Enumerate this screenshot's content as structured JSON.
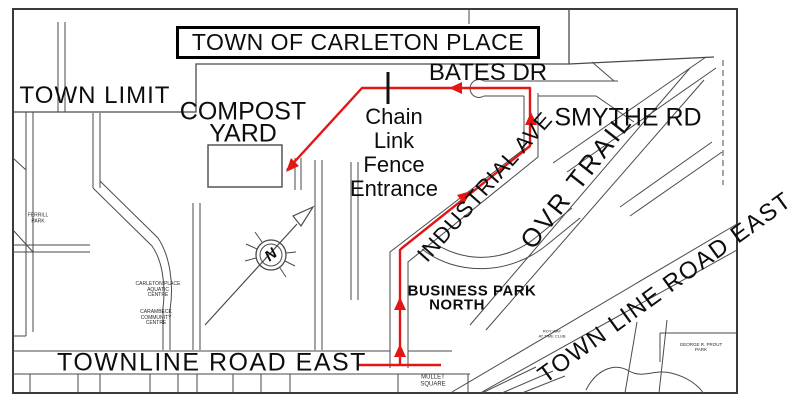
{
  "title": {
    "text": "TOWN OF CARLETON PLACE"
  },
  "areas": {
    "town_limit": "TOWN LIMIT",
    "compost_1": "COMPOST",
    "compost_2": "YARD",
    "business_1": "BUSINESS PARK",
    "business_2": "NORTH"
  },
  "roads": {
    "bates": "BATES DR",
    "smythe": "SMYTHE RD",
    "industrial": "INDUSTRIAL AVE",
    "ovr": "OVR TRAIL",
    "townline_diagonal": "TOWN LINE ROAD EAST",
    "townline_bottom": "TOWNLINE ROAD EAST"
  },
  "route": {
    "entrance_1": "Chain",
    "entrance_2": "Link",
    "entrance_3": "Fence",
    "entrance_4": "Entrance",
    "color": "#e31616"
  },
  "places": {
    "ferrill_1": "FERRILL",
    "ferrill_2": "PARK",
    "aquatic_1": "CARLETON PLACE",
    "aquatic_2": "AQUATIC",
    "aquatic_3": "CENTRE",
    "carambeck_1": "CARAMBECK",
    "carambeck_2": "COMMUNITY",
    "carambeck_3": "CENTRE",
    "mullet_1": "MULLET",
    "mullet_2": "SQUARE",
    "club_1": "ROY WAY",
    "club_2": "AT TIME CLUB",
    "prout_1": "GEORGE R. PROUT",
    "prout_2": "PARK"
  },
  "compass": {
    "north": "N"
  },
  "colors": {
    "route_red": "#e31616",
    "road_line": "#4a4a4a",
    "border": "#3a3a3a"
  }
}
